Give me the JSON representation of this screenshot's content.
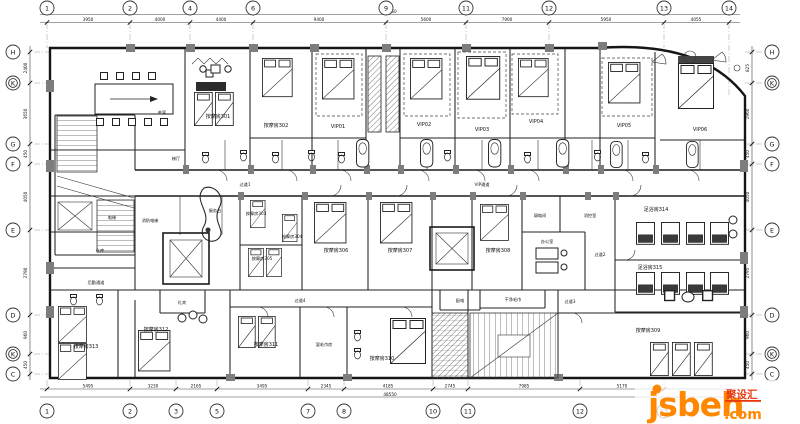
{
  "rooms": {
    "tea": "茶室",
    "lobby": "梯厅",
    "m301": "按摩房301",
    "m302": "按摩房302",
    "vip01": "VIP01",
    "vip02": "VIP02",
    "vip03": "VIP03",
    "vip04": "VIP04",
    "vip05": "VIP05",
    "vip06": "VIP06",
    "m303": "按摩房303",
    "m304": "按摩房304",
    "m305": "按摩房305",
    "m306": "按摩房306",
    "m307": "按摩房307",
    "m308": "按摩房308",
    "m309": "按摩房309",
    "m310": "按摩房310",
    "m311": "按摩房311",
    "m312": "按摩房312",
    "m313": "按摩房313",
    "foot314": "足浴房314",
    "foot315": "足浴房315",
    "service_desk": "服务台",
    "elevator": "电梯",
    "fire_elevator": "消防电梯",
    "storage": "仓库",
    "low_voltage": "弱电间",
    "fire_control": "消控室",
    "office": "办公室",
    "power": "配电",
    "clean_towel": "干净毛巾",
    "wet_towel": "湿毛巾房",
    "concierge": "礼宾"
  },
  "corridors": {
    "vip": "VIP通道",
    "c1": "过道1",
    "c2": "过道2",
    "c3": "过道3",
    "c4": "过道4",
    "logistics": "后勤通道"
  },
  "grid": {
    "top": [
      "1",
      "2",
      "4",
      "6",
      "9",
      "11",
      "12",
      "13",
      "14"
    ],
    "bottom": [
      "1",
      "2",
      "3",
      "5",
      "7",
      "8",
      "10",
      "11",
      "12",
      "13"
    ],
    "left": [
      "H",
      "K",
      "G",
      "F",
      "E",
      "D",
      "K",
      "C"
    ],
    "right": [
      "H",
      "K",
      "G",
      "F",
      "E",
      "D",
      "K",
      "C"
    ]
  },
  "dimensions": {
    "top": [
      "3950",
      "4000",
      "4400",
      "9400",
      "5600",
      "7900",
      "5950",
      "4055"
    ],
    "top_total": "48550",
    "bottom": [
      "5495",
      "3230",
      "2165",
      "3495",
      "2345",
      "4185",
      "2745",
      "7985",
      "5170"
    ],
    "bottom_total": "48550",
    "left": [
      "2400",
      "3650",
      "450",
      "4050",
      "2790",
      "960",
      "450"
    ],
    "right": [
      "825",
      "1960",
      "450",
      "4050",
      "2795",
      "960",
      "450"
    ]
  },
  "watermark": {
    "brand": "jsbeh",
    "tld": ".com",
    "badge": "聚设汇"
  }
}
